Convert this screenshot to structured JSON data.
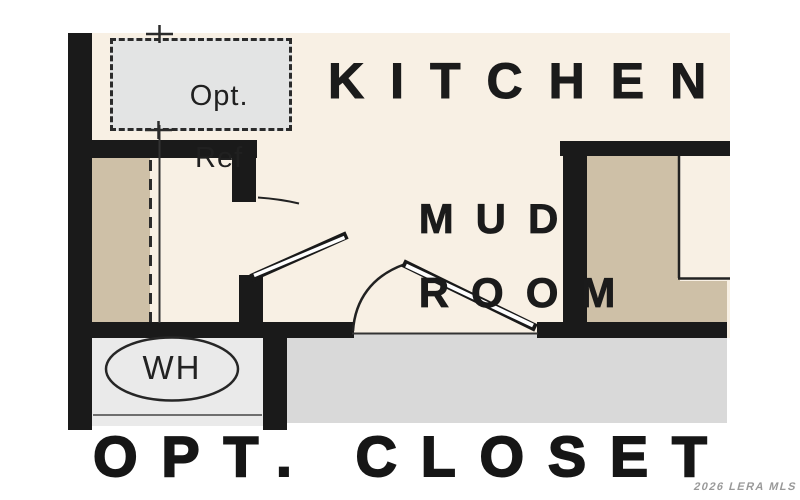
{
  "floor_plan": {
    "kitchen": {
      "label": "KITCHEN"
    },
    "mud_room": {
      "label_line1": "MUD",
      "label_line2": "ROOM"
    },
    "optional_refrigerator": {
      "label_line1": "Opt.",
      "label_line2": "Ref"
    },
    "water_heater": {
      "label": "WH"
    },
    "optional_closet": {
      "label": "OPT. CLOSET"
    }
  },
  "watermark": {
    "text": "2026 LERA MLS"
  },
  "colors": {
    "wall": "#1a1a1a",
    "floor_cream": "#f8f0e4",
    "cabinet_tan": "#cec0a7",
    "hallway_gray": "#d9d9d9",
    "closet_gray": "#eaeaea",
    "optional_box_gray": "#e3e4e4",
    "background": "#ffffff"
  }
}
